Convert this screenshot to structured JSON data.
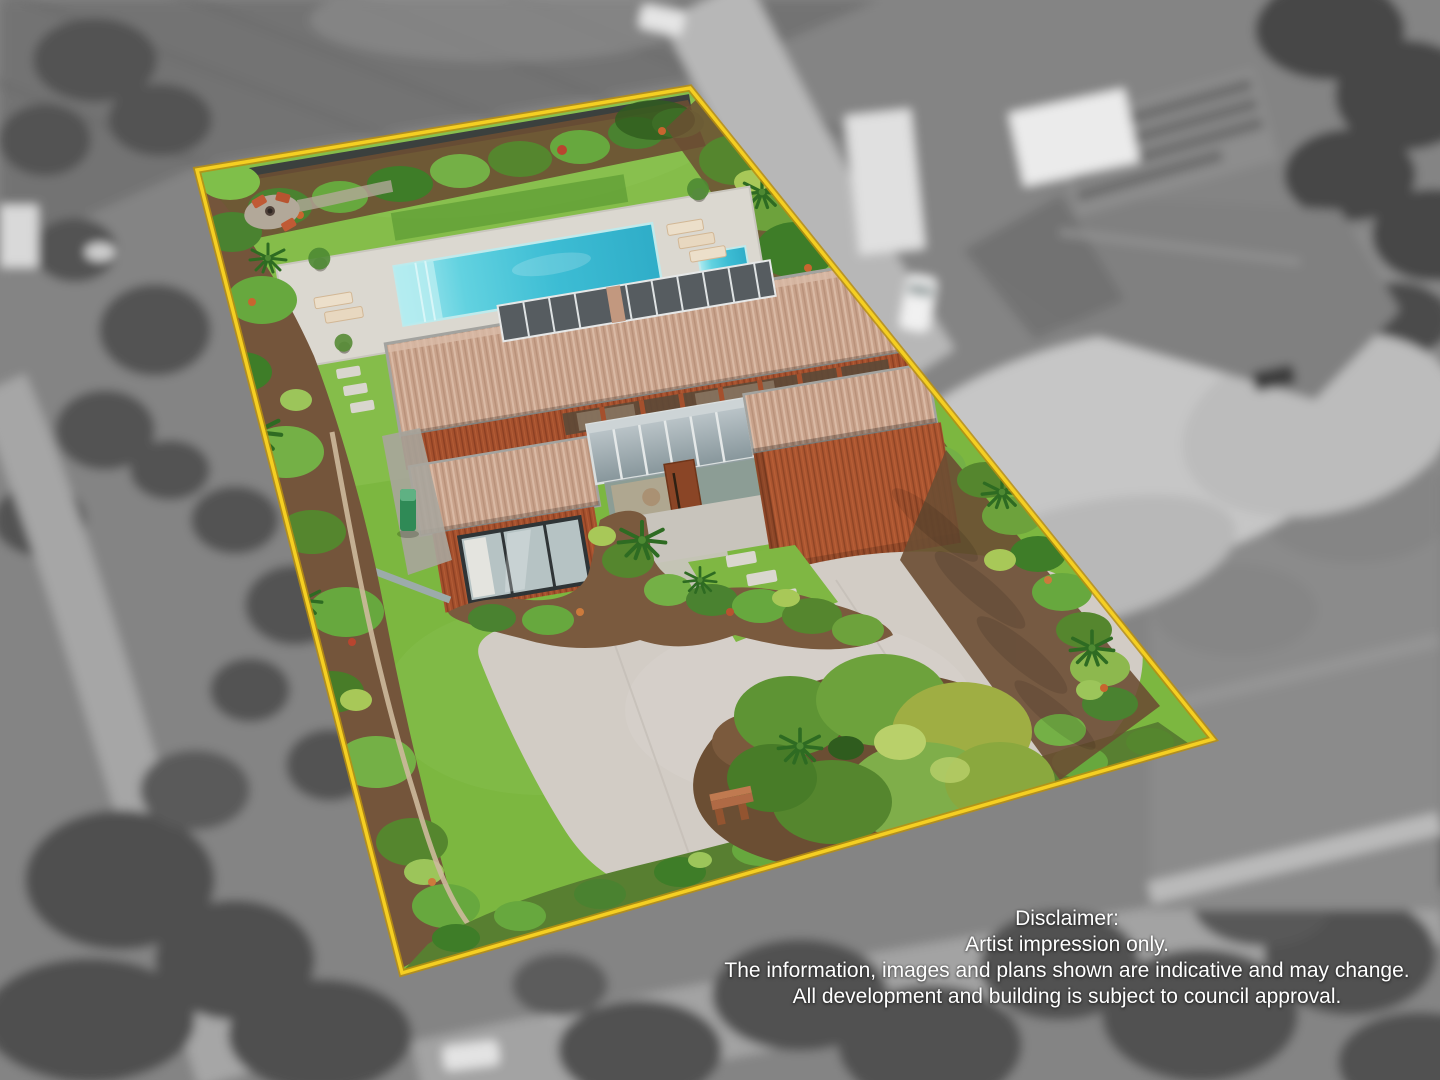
{
  "disclaimer": {
    "title": "Disclaimer:",
    "lines": [
      "Artist impression only.",
      "The information, images and plans shown are indicative and may change.",
      "All development and building is subject to council approval."
    ]
  },
  "boundary": {
    "shape": "quadrilateral",
    "color": "#f2ca1d"
  },
  "palette": {
    "boundary_yellow": "#f2ca1d",
    "lawn_green": "#7cb740",
    "pool_water": "#3fbdd5",
    "pool_deck": "#dbd8d0",
    "roof_tan": "#c8a28b",
    "timber_cladding": "#a5502d",
    "driveway_concrete": "#d2ccc5",
    "garden_mulch": "#74553b",
    "background_grayscale": "#848484",
    "text_white": "#ffffff"
  },
  "scene": {
    "overlay_type": "colour artist impression inside yellow property boundary over grayscale aerial photo",
    "landmarks": [
      "swimming pool",
      "spa",
      "sun loungers",
      "pool deck",
      "modern timber house",
      "glass atrium entry",
      "garage",
      "curved driveway",
      "front lawn",
      "backyard lawn",
      "tropical garden beds",
      "garden island with bench",
      "fire-pit patio",
      "neighbouring house (grayscale)",
      "rural road"
    ]
  }
}
